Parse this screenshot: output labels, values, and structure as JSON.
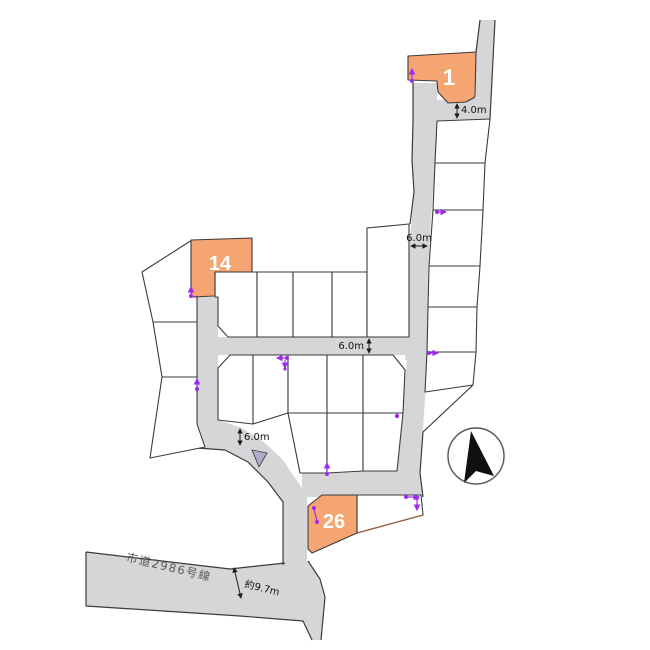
{
  "map": {
    "lots": [
      {
        "number": "1"
      },
      {
        "number": "14"
      },
      {
        "number": "26"
      }
    ],
    "dimensions": {
      "top_road": "4.0m",
      "right_road": "6.0m",
      "middle_road": "6.0m",
      "junction_road": "6.0m",
      "bottom_road_width": "約9.7m"
    },
    "road_name": "市道2986号線",
    "compass": {
      "direction_label": "north"
    },
    "colors": {
      "lot_highlight": "#f5a571",
      "road_fill": "#d6d6d8",
      "boundary": "#3b3b3b",
      "marker": "#9b2bf0",
      "triangle": "#b4a9cd",
      "brown_edge": "#9a6248",
      "label_gray": "#5a5a5a"
    }
  }
}
